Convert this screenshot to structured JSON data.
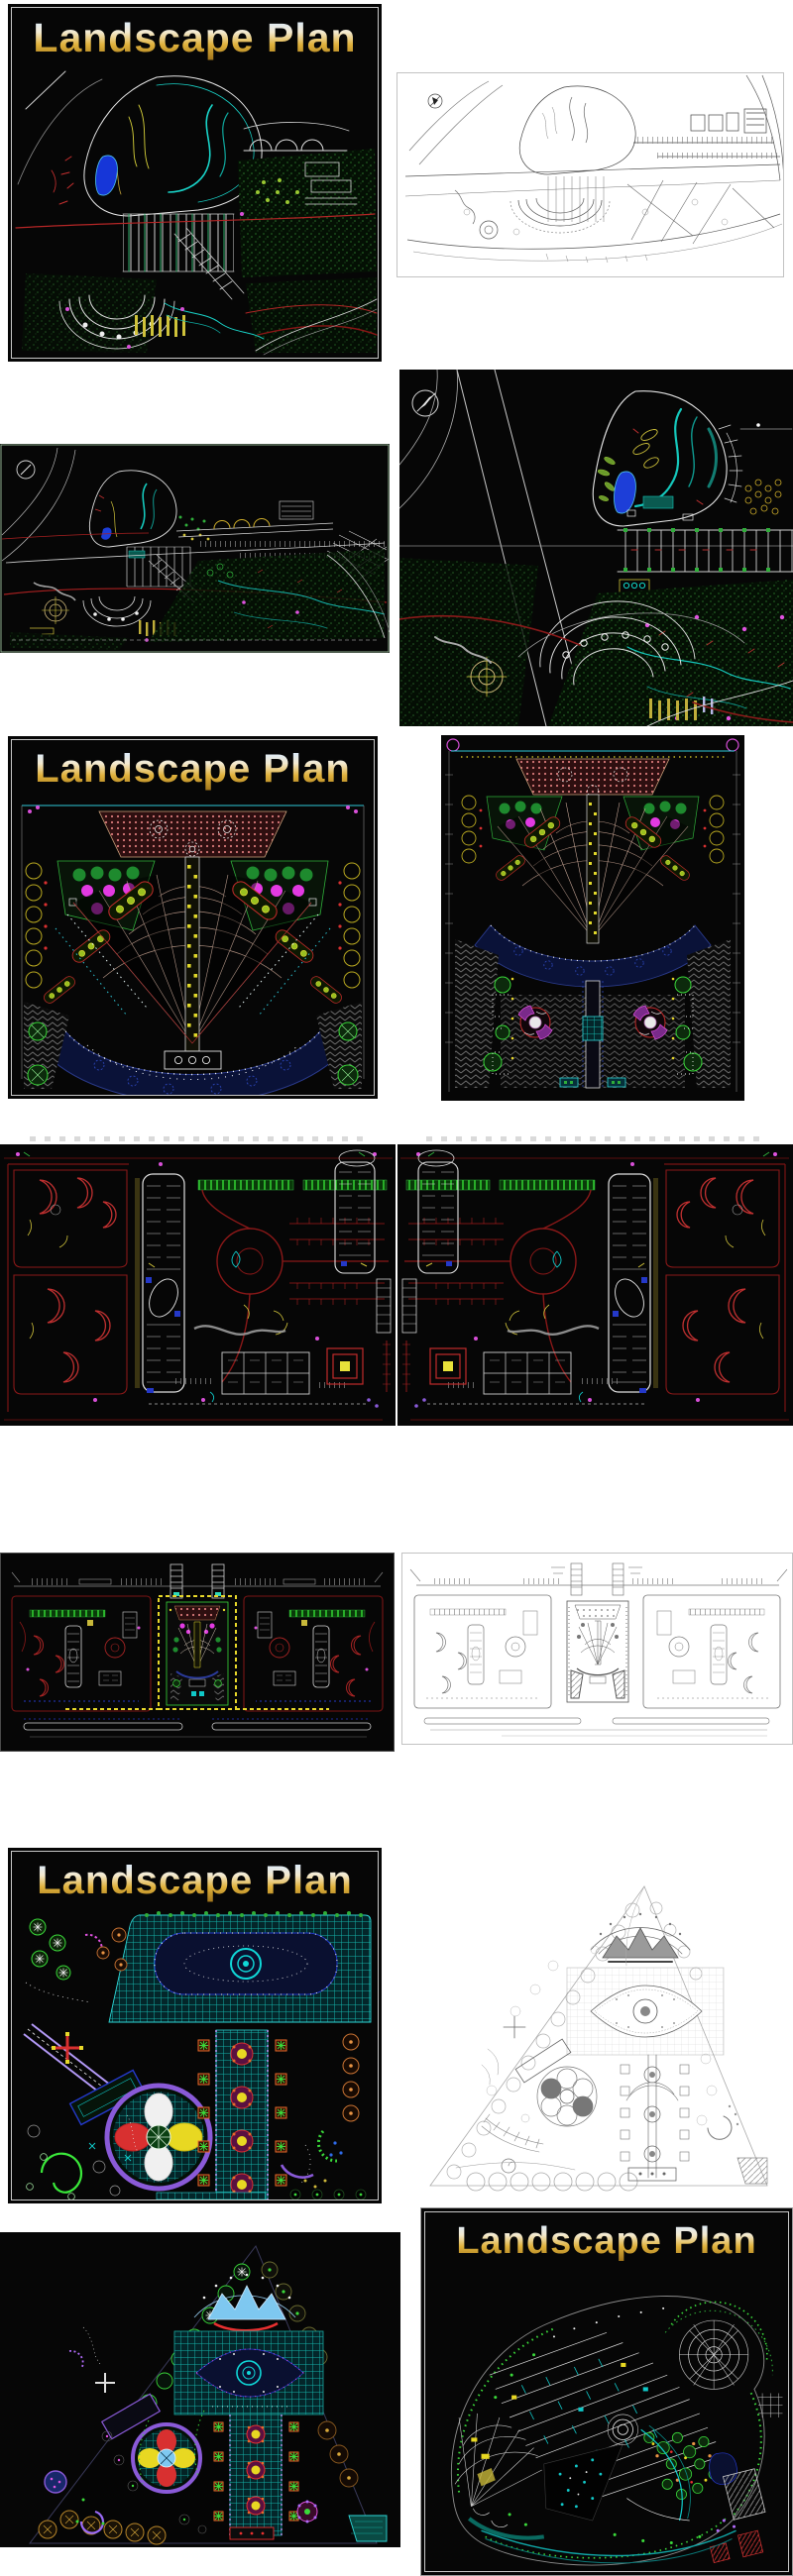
{
  "collage": {
    "background": "#ffffff",
    "theme": "CAD landscape drawings gallery"
  },
  "palette": {
    "cad_background": "#060606",
    "title_gradient_top": "#a8ccf4",
    "title_gradient_bottom": "#8a5f10",
    "cad_cyan": "#15c8bc",
    "cad_green": "#3ad83a",
    "cad_dark_red": "#8a1818",
    "cad_red": "#d83030",
    "cad_yellow": "#e8d82a",
    "cad_magenta": "#e052e0",
    "cad_blue": "#2438c8",
    "cad_white": "#e8e8e8",
    "paper_line": "#555555"
  },
  "tiles": [
    {
      "id": "hillside-park-dark-titled",
      "title": "Landscape Plan"
    },
    {
      "id": "hillside-park-light"
    },
    {
      "id": "hillside-park-zoom-dark"
    },
    {
      "id": "hillside-park-full-dark"
    },
    {
      "id": "fan-plaza-titled",
      "title": "Landscape Plan"
    },
    {
      "id": "fan-plaza-tall"
    },
    {
      "id": "resort-site-plan-left"
    },
    {
      "id": "resort-site-plan-right"
    },
    {
      "id": "panorama-dark"
    },
    {
      "id": "panorama-light"
    },
    {
      "id": "garden-plan-titled",
      "title": "Landscape Plan"
    },
    {
      "id": "triangle-park-light"
    },
    {
      "id": "triangle-park-dark"
    },
    {
      "id": "curved-community-titled",
      "title": "Landscape Plan"
    }
  ]
}
